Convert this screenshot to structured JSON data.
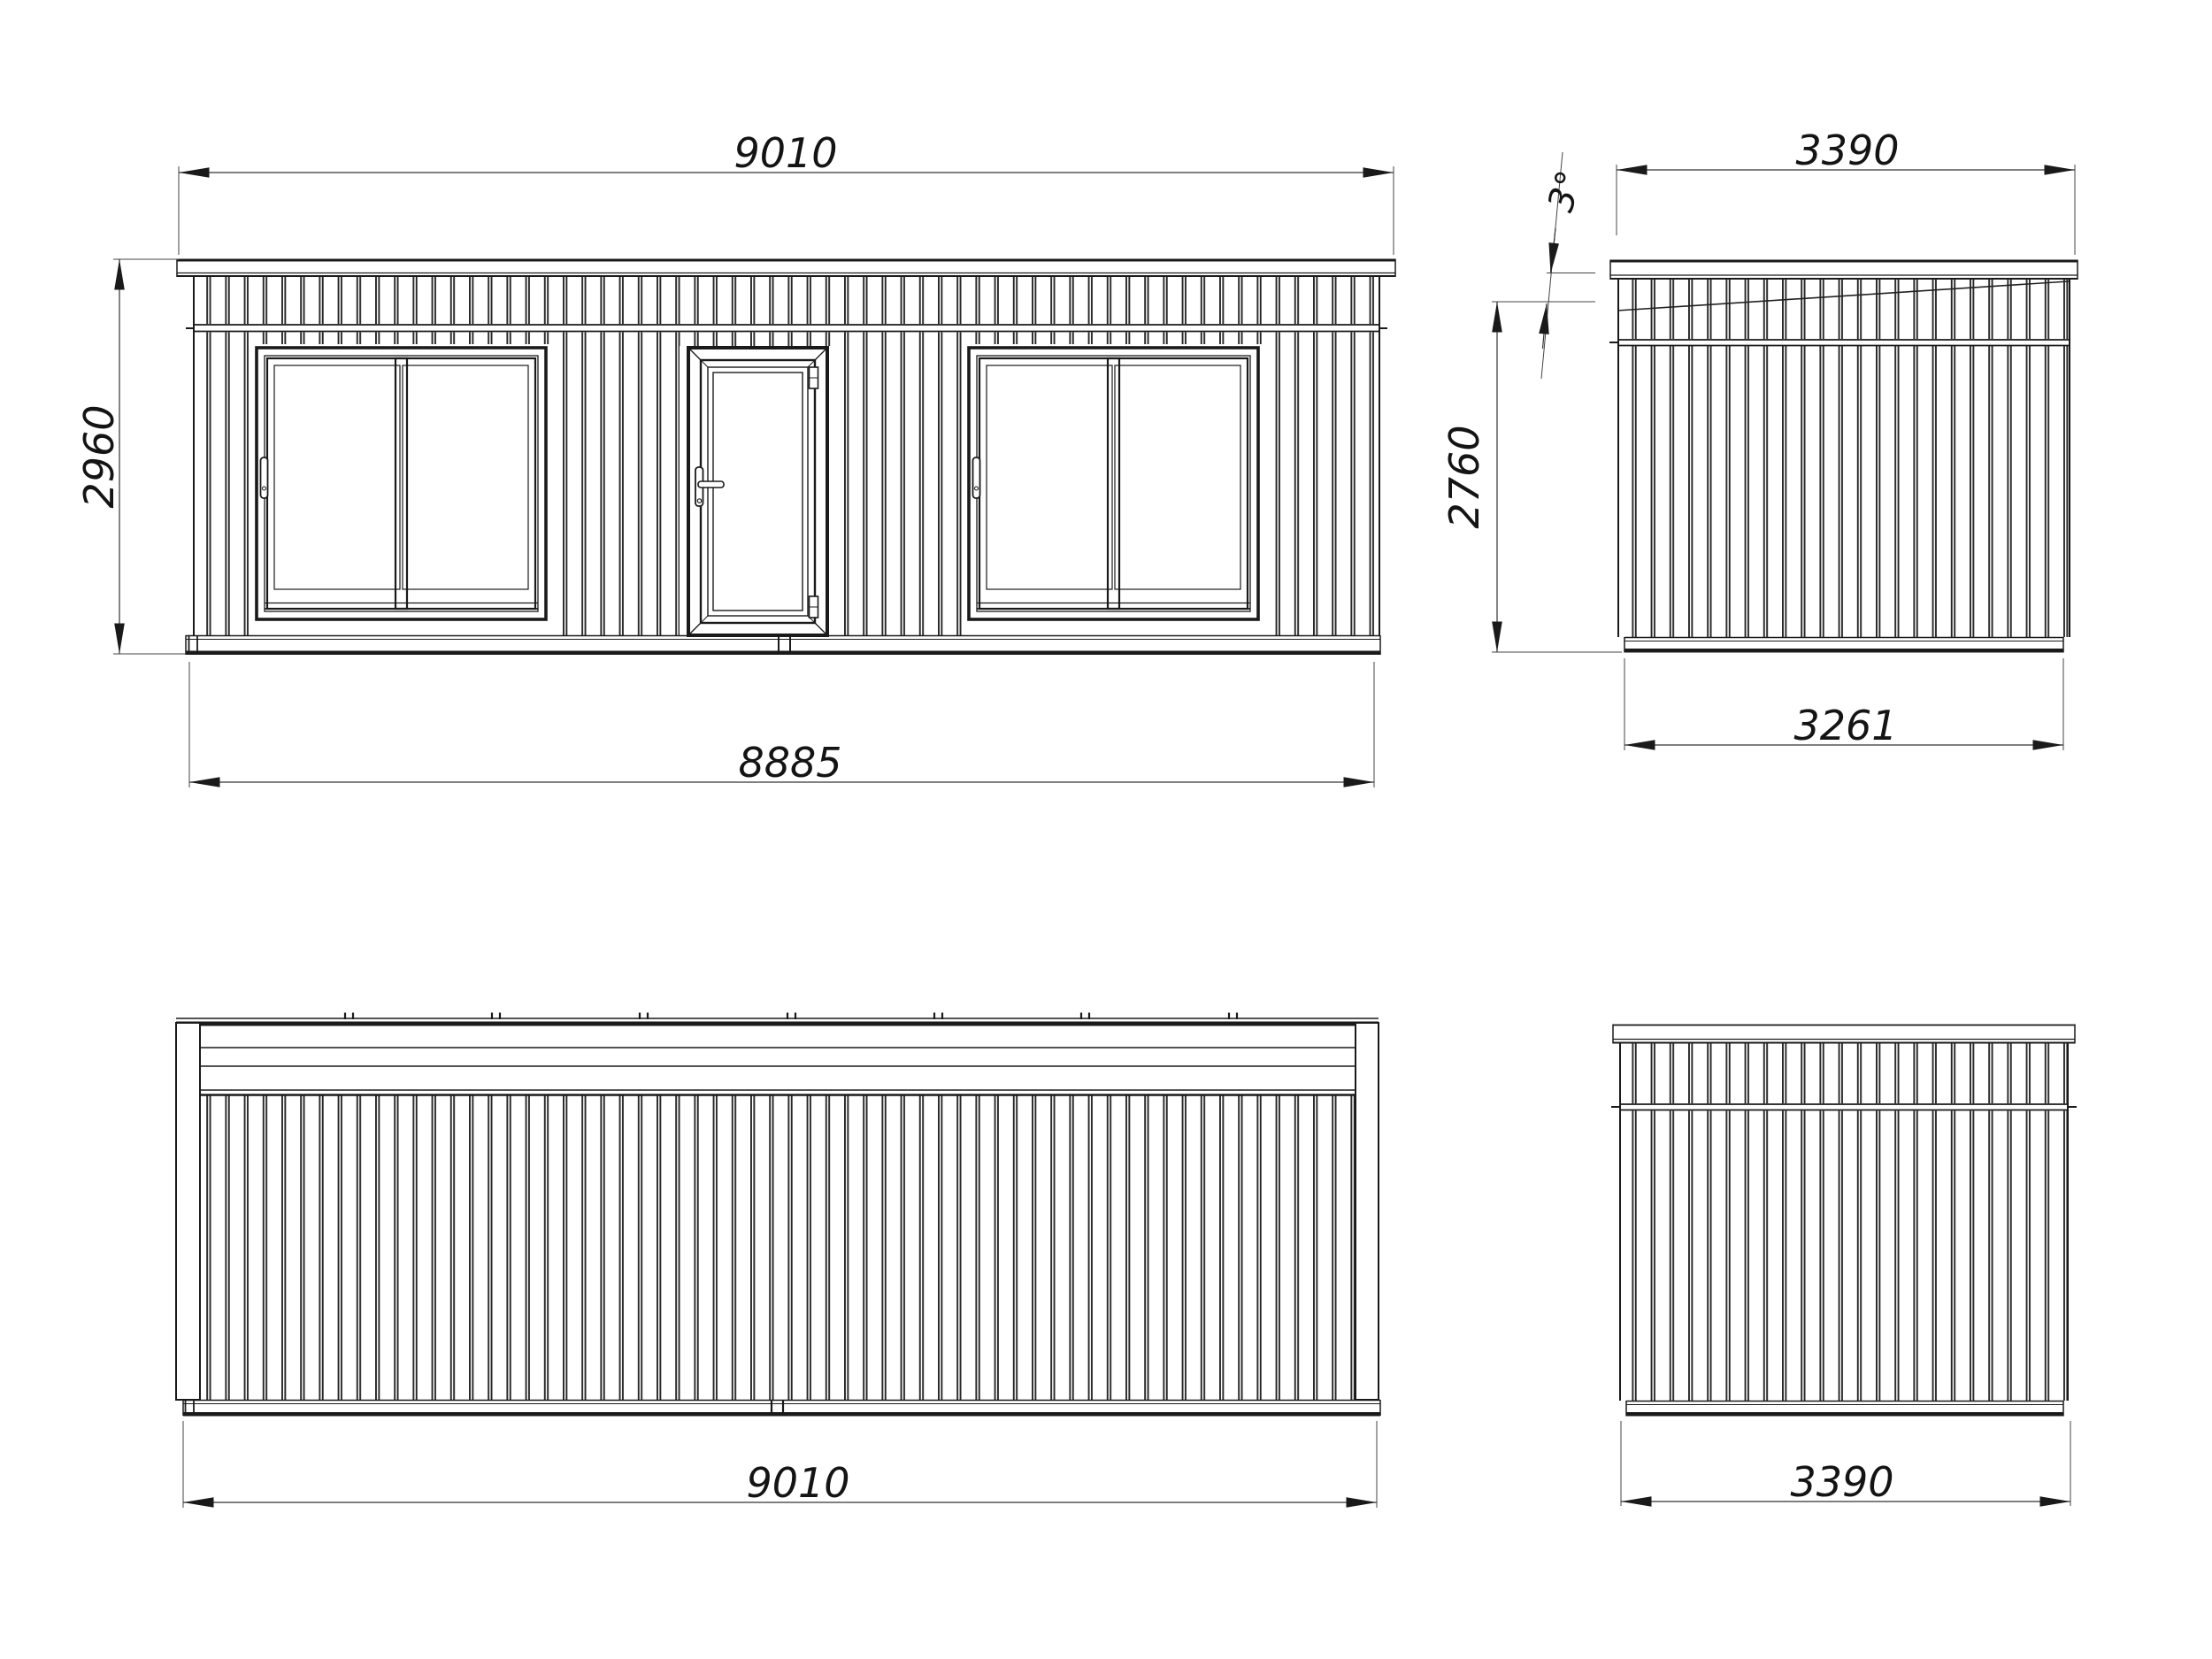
{
  "views": {
    "front": {
      "dim_top": "9010",
      "dim_height": "2960",
      "dim_bottom": "8885"
    },
    "right_side": {
      "dim_top": "3390",
      "roof_slope": "3°",
      "dim_height": "2760",
      "dim_bottom": "3261"
    },
    "rear": {
      "dim_bottom": "9010"
    },
    "left_side": {
      "dim_bottom": "3390"
    }
  },
  "colors": {
    "line": "#1a1a1a",
    "dim": "#333333",
    "text": "#141414",
    "bg": "#ffffff"
  }
}
